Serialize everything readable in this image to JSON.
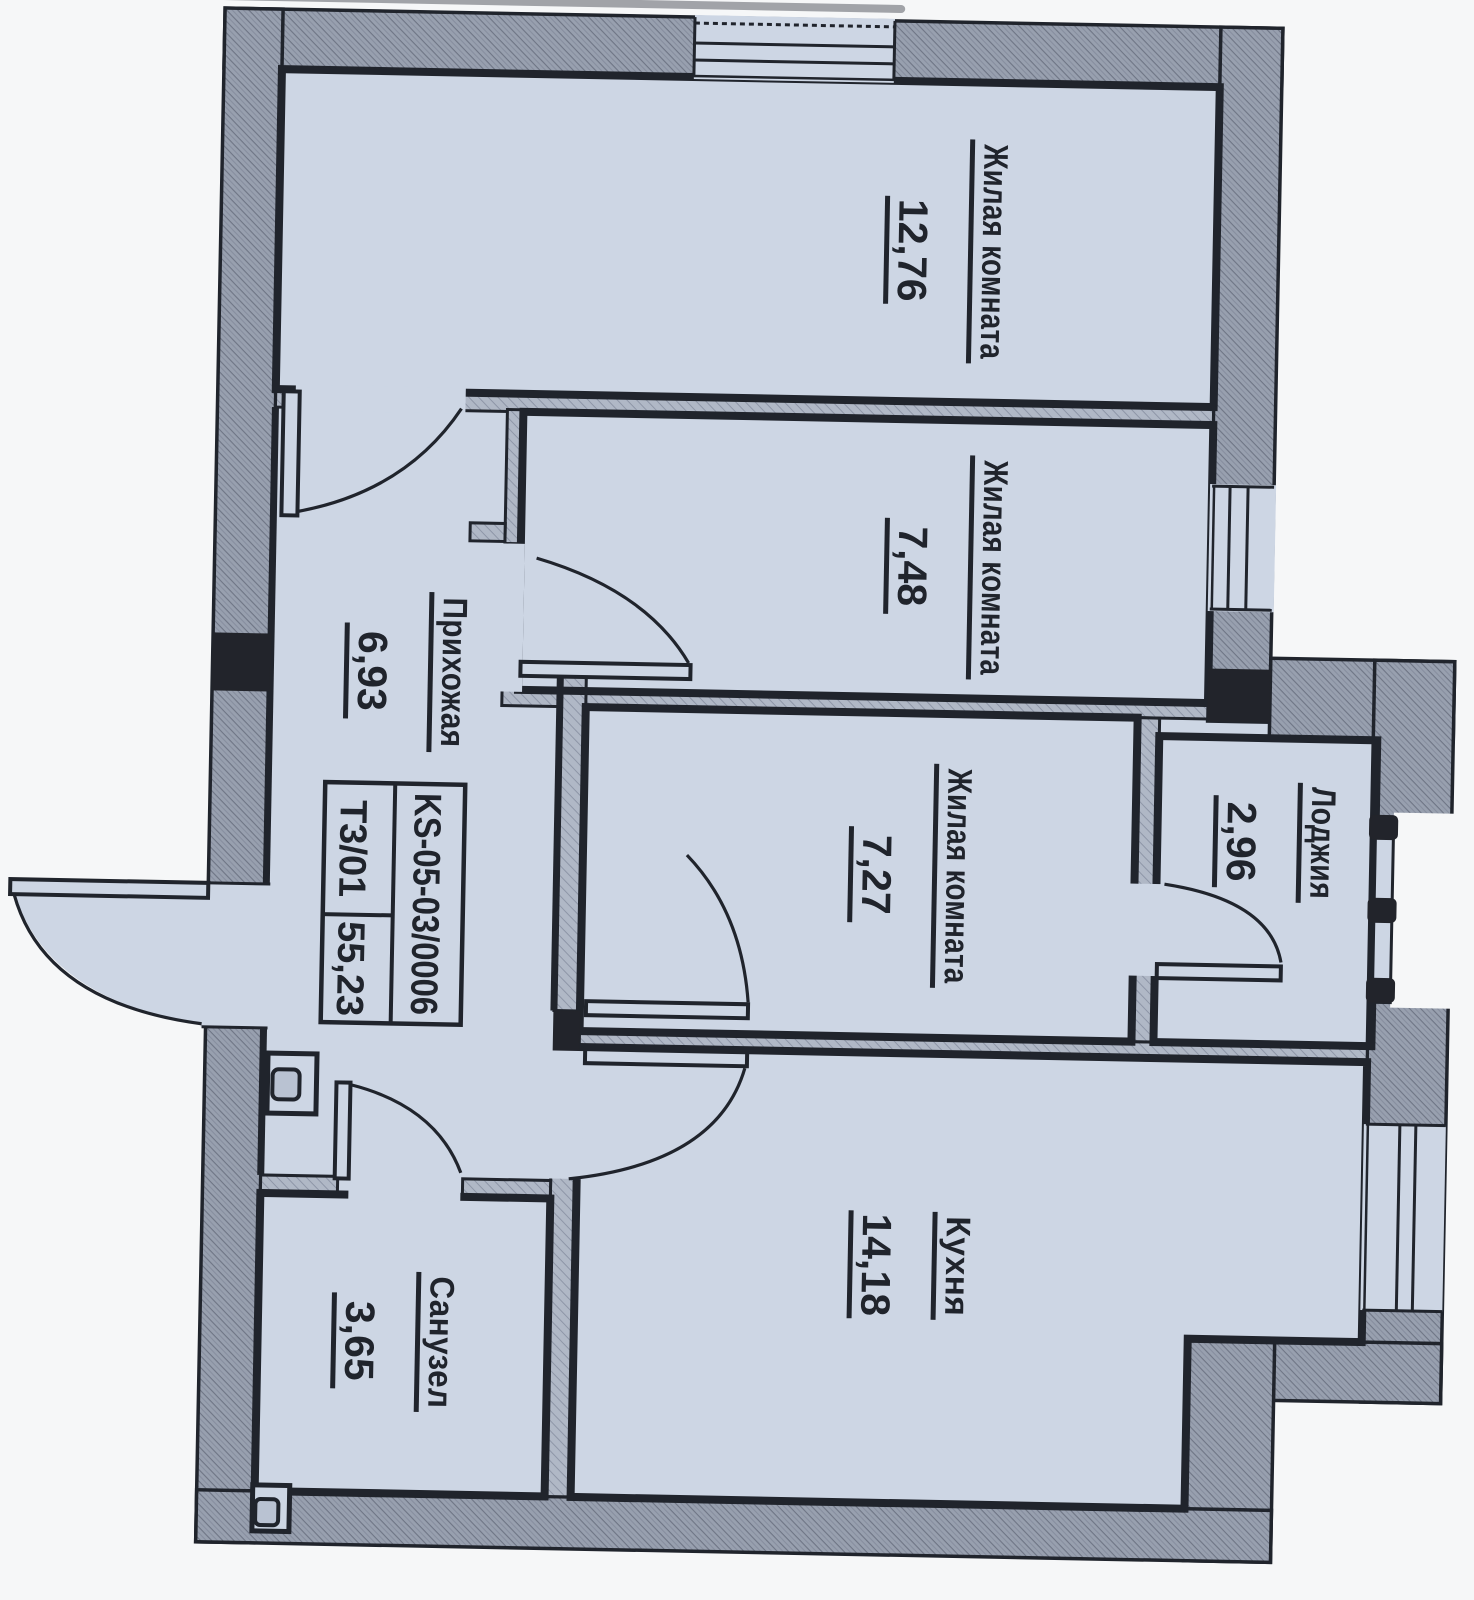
{
  "rooms": [
    {
      "name": "Жилая комната",
      "area": "12,76"
    },
    {
      "name": "Жилая комната",
      "area": "7,48"
    },
    {
      "name": "Жилая комната",
      "area": "7,27"
    },
    {
      "name": "Прихожая",
      "area": "6,93"
    },
    {
      "name": "Лоджия",
      "area": "2,96"
    },
    {
      "name": "Кухня",
      "area": "14,18"
    },
    {
      "name": "Санузел",
      "area": "3,65"
    }
  ],
  "stamp": {
    "code": "KS-05-03/0006",
    "unit": "Т3/01",
    "area_total": "55,23"
  },
  "colors": {
    "paper": "#cdd6e4",
    "wall_exterior": "#98a0af",
    "wall_interior": "#aeb6c4",
    "line": "#20242c",
    "page": "#f6f7f8"
  }
}
